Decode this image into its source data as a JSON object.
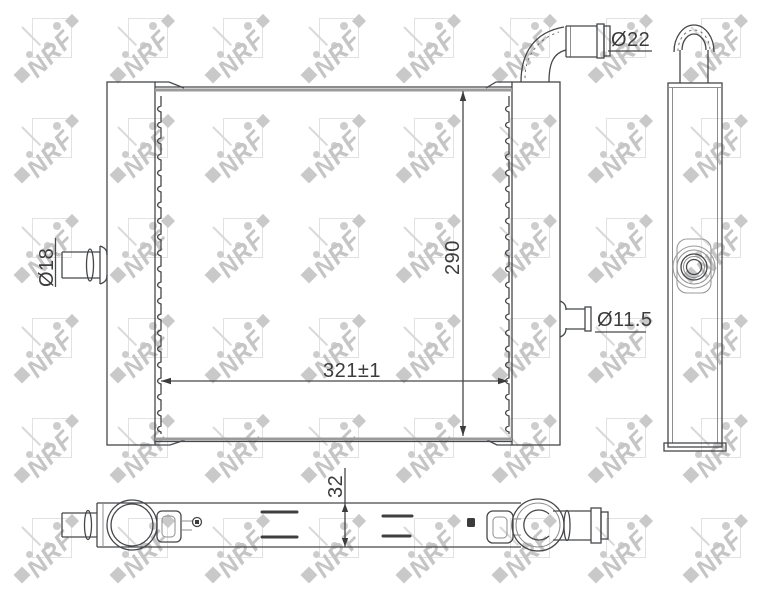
{
  "watermark": {
    "text": "NRF",
    "color": "#c5c5c5"
  },
  "labels": {
    "top_port_diameter": "Ø22",
    "left_port_diameter": "Ø18",
    "right_port_diameter": "Ø11.5",
    "core_height": "290",
    "core_width_tolerance": "321±1",
    "core_depth": "32"
  },
  "views": {
    "front": "front-view",
    "side": "side-view",
    "bottom": "bottom-view"
  },
  "style": {
    "line_color": "#45474a",
    "thick_line_color": "#9b9b9b",
    "dimension_text_color": "#3c3c3c",
    "background_color": "#ffffff"
  }
}
